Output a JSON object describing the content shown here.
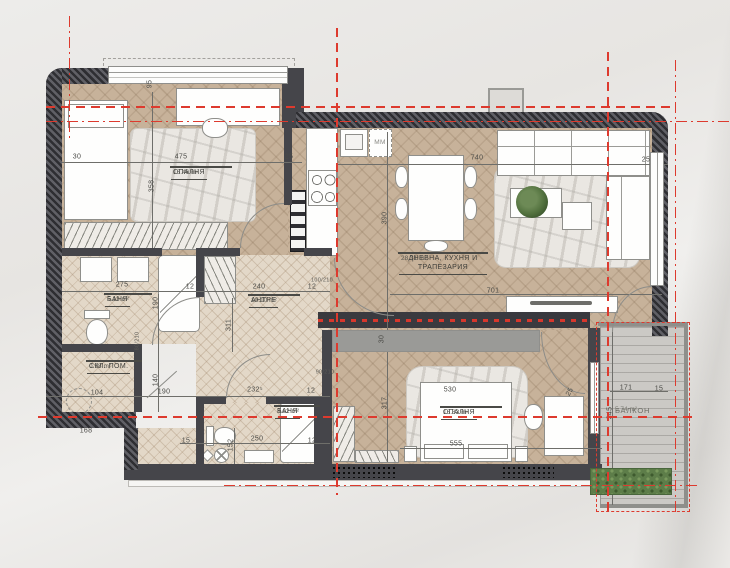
{
  "title": "apartment-floor-plan",
  "rooms": [
    {
      "id": "bedroom-1",
      "name": "СПАЛНЯ",
      "area": "16.46 m²"
    },
    {
      "id": "bathroom-1",
      "name": "БАНЯ",
      "area": "5.13 m²"
    },
    {
      "id": "storage",
      "name": "СКЛ. ПОМ.",
      "area": "0.98 m²"
    },
    {
      "id": "hallway",
      "name": "АНТРЕ",
      "area": "10.10 m²"
    },
    {
      "id": "living-kitchen-dining",
      "name": "ДНЕВНА, КУХНЯ И ТРАПЕЗАРИЯ",
      "area": "28.31 m²"
    },
    {
      "id": "bedroom-2",
      "name": "СПАЛНЯ",
      "area": "16.83 m²"
    },
    {
      "id": "bathroom-2",
      "name": "БАНЯ",
      "area": "3.62 m²"
    },
    {
      "id": "balcony",
      "name": "БАЛКОН",
      "area": "5.74 m²"
    }
  ],
  "labels": {
    "washing_machine": "MM"
  },
  "dimensions": [
    {
      "t": "30",
      "x": 77,
      "y": 157,
      "r": 0
    },
    {
      "t": "475",
      "x": 181,
      "y": 157,
      "r": 0
    },
    {
      "t": "25",
      "x": 289,
      "y": 157,
      "r": 0
    },
    {
      "t": "358",
      "x": 152,
      "y": 186,
      "r": -90
    },
    {
      "t": "95",
      "x": 150,
      "y": 84,
      "r": -90
    },
    {
      "t": "740",
      "x": 477,
      "y": 158,
      "r": 0
    },
    {
      "t": "25",
      "x": 646,
      "y": 160,
      "r": 0
    },
    {
      "t": "390",
      "x": 385,
      "y": 218,
      "r": -90
    },
    {
      "t": "701",
      "x": 493,
      "y": 291,
      "r": 0
    },
    {
      "t": "275",
      "x": 122,
      "y": 285,
      "r": 0
    },
    {
      "t": "12",
      "x": 190,
      "y": 287,
      "r": 0
    },
    {
      "t": "190",
      "x": 156,
      "y": 303,
      "r": -90
    },
    {
      "t": "311",
      "x": 229,
      "y": 325,
      "r": -90
    },
    {
      "t": "80/210",
      "x": 138,
      "y": 341,
      "r": -90,
      "s": 1
    },
    {
      "t": "240",
      "x": 259,
      "y": 287,
      "r": 0
    },
    {
      "t": "12",
      "x": 312,
      "y": 287,
      "r": 0
    },
    {
      "t": "100/210",
      "x": 322,
      "y": 281,
      "r": 0,
      "s": 1
    },
    {
      "t": "90/210",
      "x": 325,
      "y": 373,
      "r": 0,
      "s": 1
    },
    {
      "t": "30",
      "x": 382,
      "y": 339,
      "r": -90
    },
    {
      "t": "232⁵",
      "x": 255,
      "y": 390,
      "r": 0
    },
    {
      "t": "12",
      "x": 311,
      "y": 391,
      "r": 0
    },
    {
      "t": "317",
      "x": 385,
      "y": 403,
      "r": -90
    },
    {
      "t": "530",
      "x": 450,
      "y": 390,
      "r": 0
    },
    {
      "t": "555",
      "x": 456,
      "y": 444,
      "r": 0
    },
    {
      "t": "25",
      "x": 570,
      "y": 392,
      "r": -60
    },
    {
      "t": "171",
      "x": 626,
      "y": 388,
      "r": 0
    },
    {
      "t": "15",
      "x": 659,
      "y": 389,
      "r": 0
    },
    {
      "t": "345",
      "x": 610,
      "y": 413,
      "r": -90
    },
    {
      "t": "104",
      "x": 97,
      "y": 393,
      "r": 0
    },
    {
      "t": "190",
      "x": 164,
      "y": 392,
      "r": 0
    },
    {
      "t": "140",
      "x": 156,
      "y": 380,
      "r": -90
    },
    {
      "t": "168",
      "x": 86,
      "y": 431,
      "r": 0
    },
    {
      "t": "15",
      "x": 186,
      "y": 441,
      "r": 0
    },
    {
      "t": "152",
      "x": 231,
      "y": 445,
      "r": -90
    },
    {
      "t": "250",
      "x": 257,
      "y": 439,
      "r": 0
    },
    {
      "t": "12",
      "x": 312,
      "y": 441,
      "r": 0
    }
  ],
  "colors": {
    "wall": "#45454a",
    "wood_floor": "#c7b29a",
    "tile_floor": "#e3d8c8",
    "section_red": "#dd3a2e",
    "plant_green": "#53723f",
    "background": "#eceae7"
  }
}
